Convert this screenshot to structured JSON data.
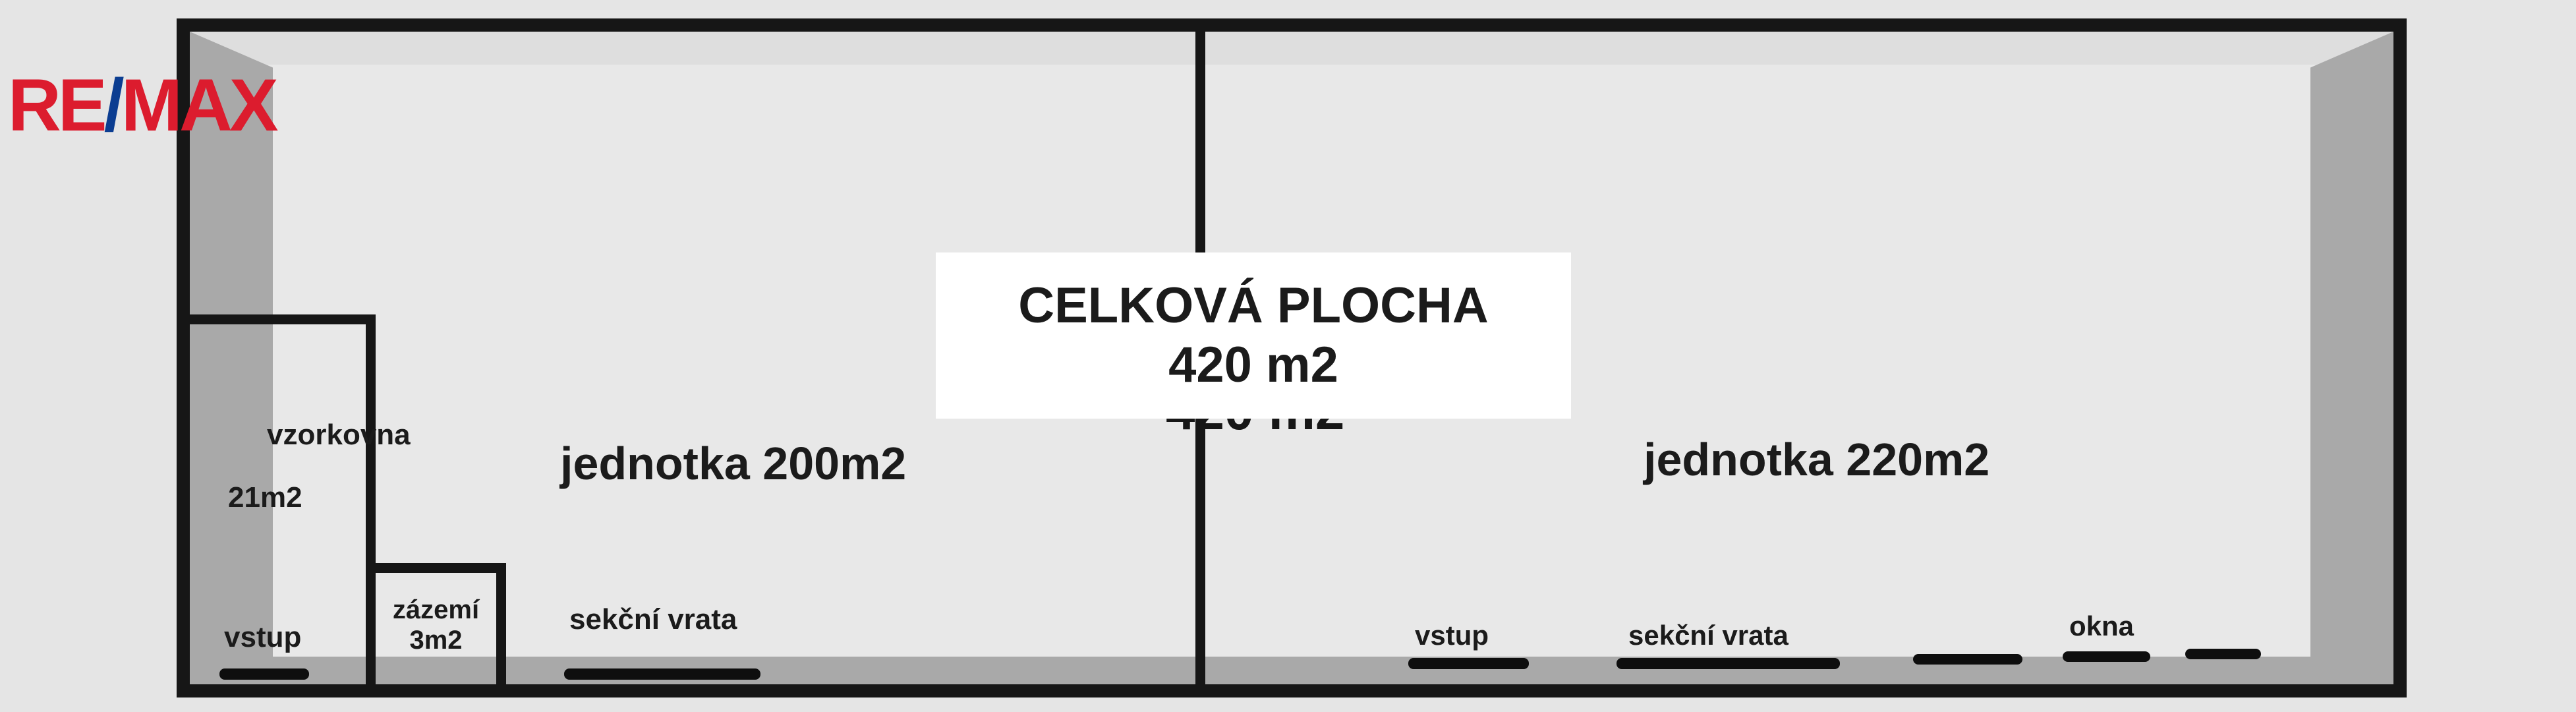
{
  "brand": {
    "re": "RE",
    "slash": "/",
    "max": "MAX"
  },
  "colors": {
    "background": "#e5e5e5",
    "interior": "#e8e8e8",
    "wall_shade": "#a9a9a9",
    "top_inner_shade": "#dedede",
    "outline_black": "#161616",
    "label_box": "#ffffff",
    "text": "#1b1b1b",
    "brand_red": "#dc1c2e",
    "brand_blue": "#0b3d91"
  },
  "total_area_label": {
    "line1": "CELKOVÁ PLOCHA",
    "line2": "420 m2"
  },
  "covered_text": "420 m2",
  "units": [
    {
      "label": "jednotka 200m2"
    },
    {
      "label": "jednotka 220m2"
    }
  ],
  "rooms": [
    {
      "name": "vzorkovna",
      "area": "21m2"
    },
    {
      "name": "zázemí",
      "area": "3m2"
    }
  ],
  "markers": {
    "left_unit": {
      "entrance": "vstup",
      "sectional_door": "sekční vrata"
    },
    "right_unit": {
      "entrance": "vstup",
      "sectional_door": "sekční vrata",
      "windows": "okna"
    }
  }
}
